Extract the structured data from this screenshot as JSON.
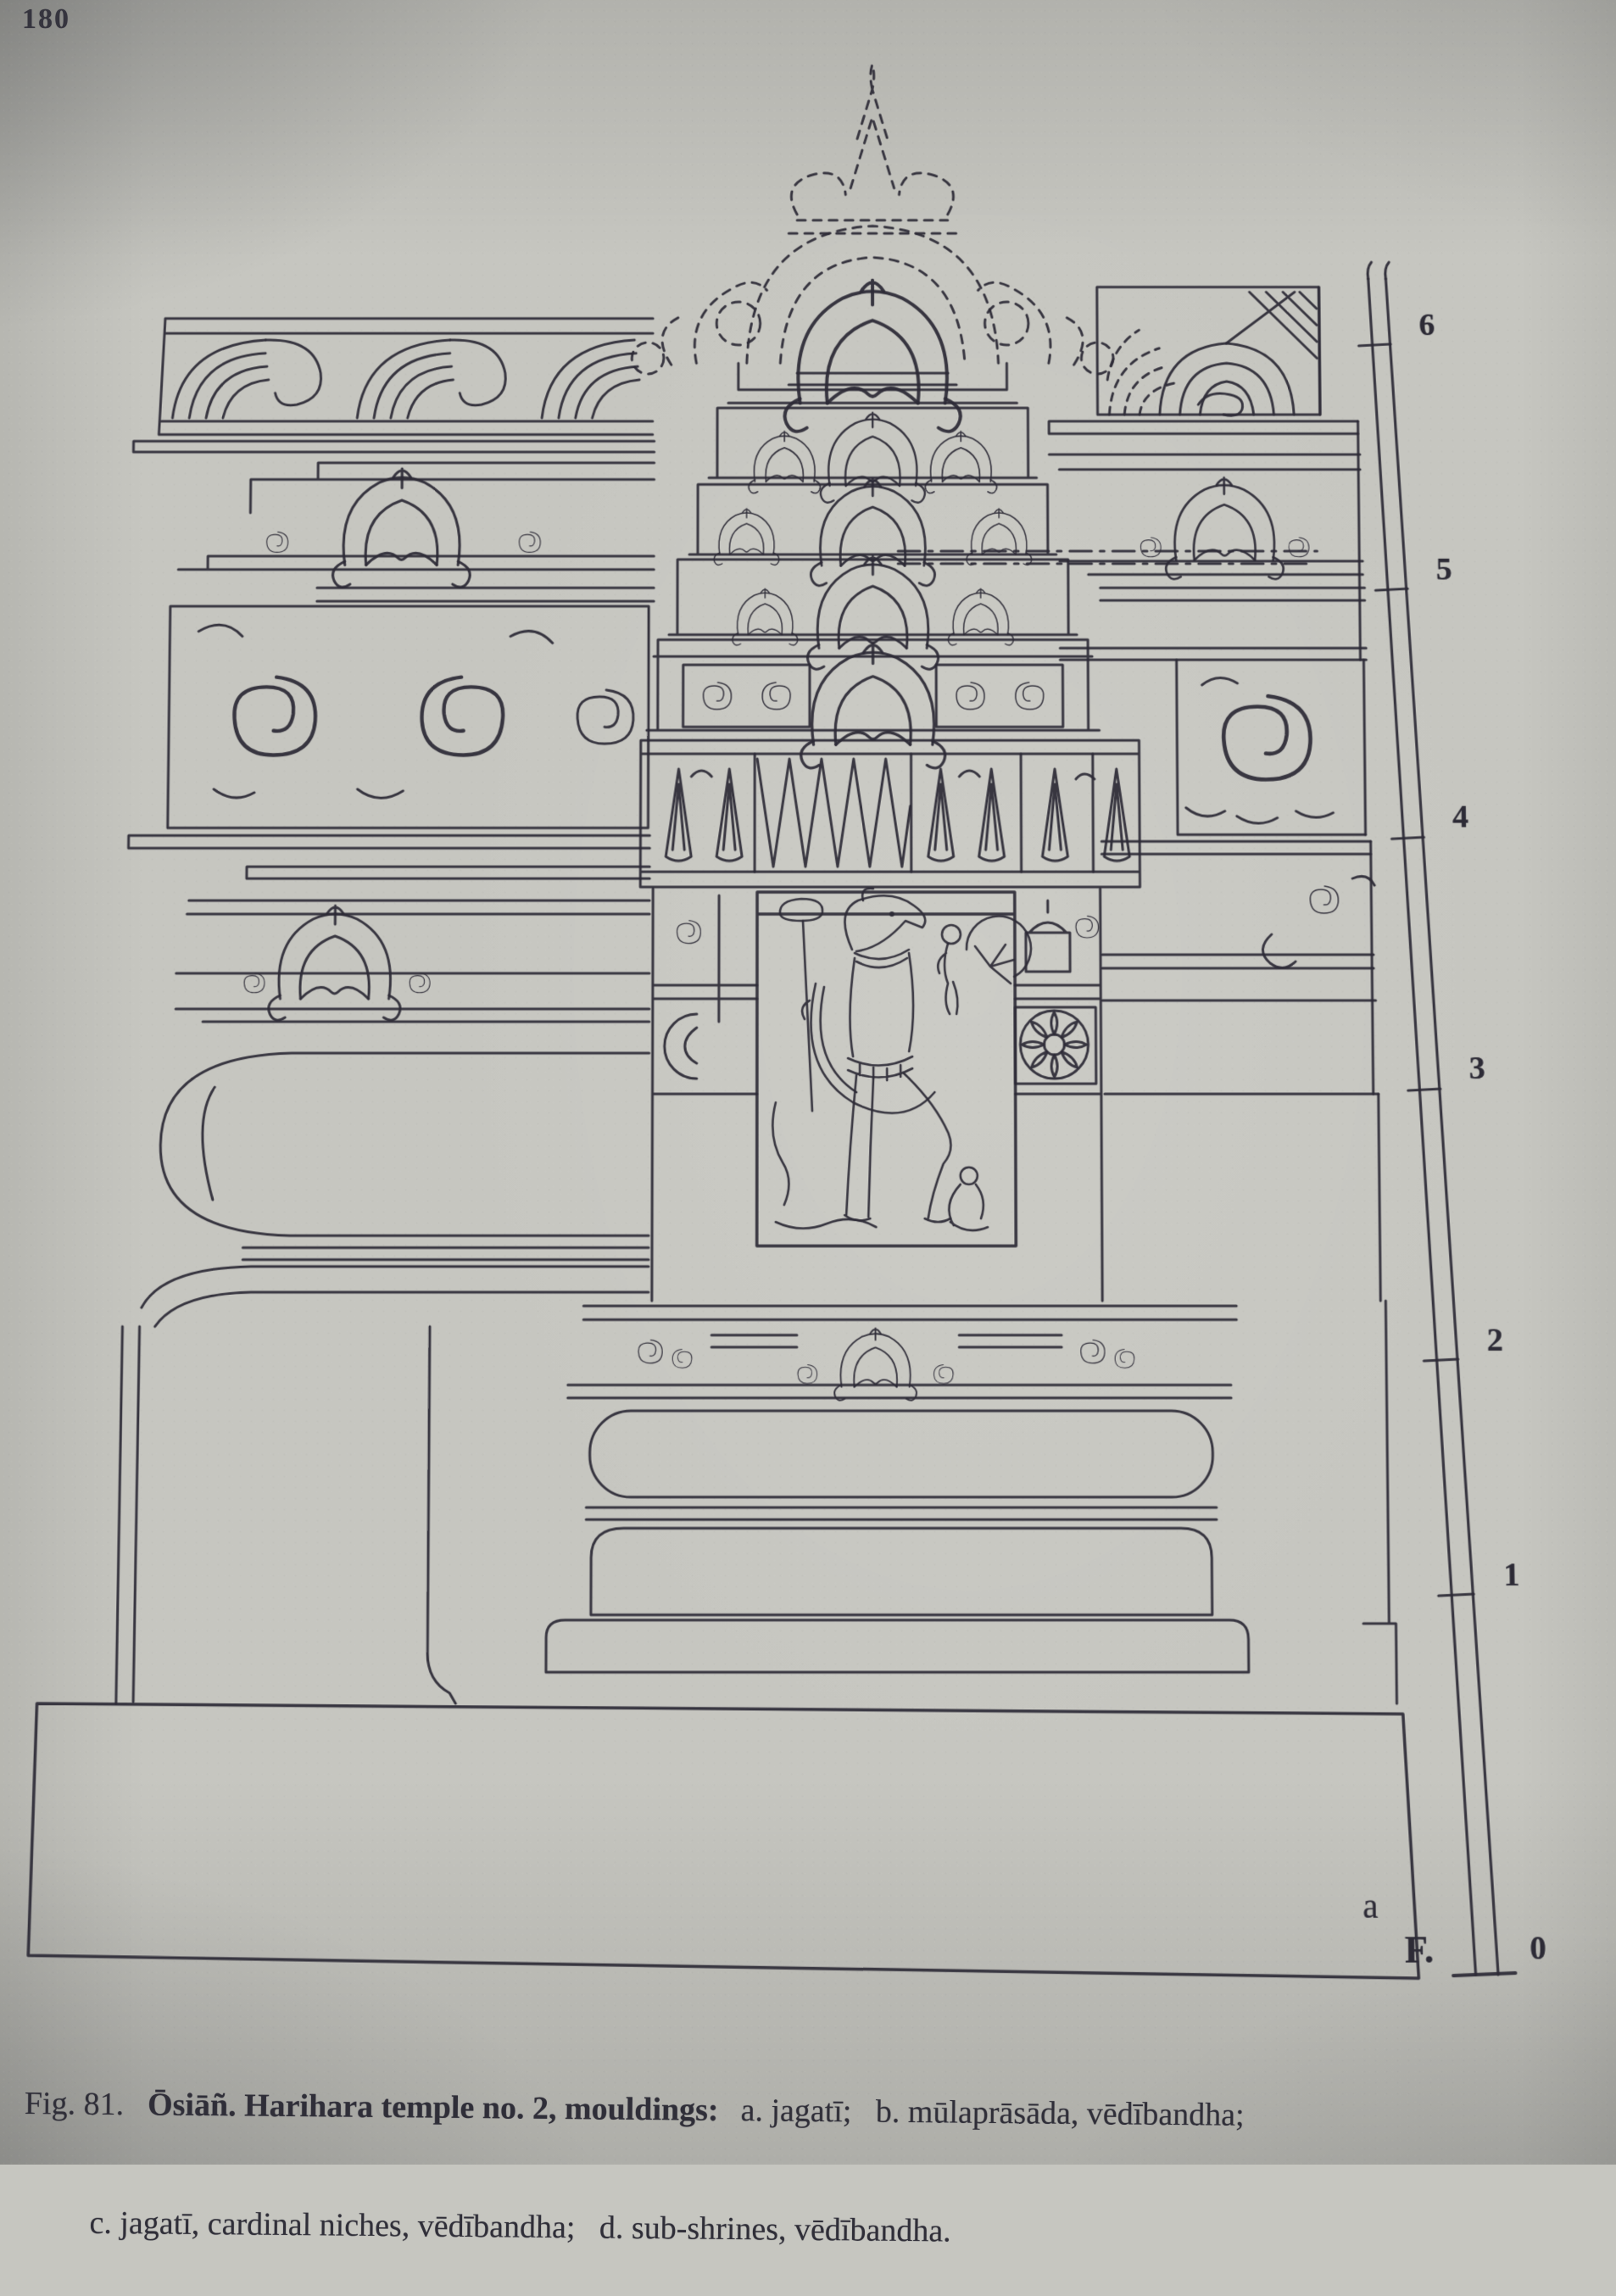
{
  "page": {
    "number": "180"
  },
  "figure": {
    "caption": {
      "fig_label": "Fig. 81.",
      "title": "Ōsiāñ. Harihara temple no. 2, mouldings:",
      "items_line1": "a. jagatī;   b. mūlaprāsāda, vēdībandha;",
      "items_line2": "c. jagatī, cardinal niches, vēdībandha;   d. sub-shrines, vēdībandha."
    },
    "part_labels": {
      "a": "a"
    },
    "scale": {
      "unit_label": "F.",
      "ticks": [
        "6",
        "5",
        "4",
        "3",
        "2",
        "1",
        "0"
      ]
    },
    "ink_color": "#2c2a36",
    "paper_color": "#c6c6c0"
  }
}
